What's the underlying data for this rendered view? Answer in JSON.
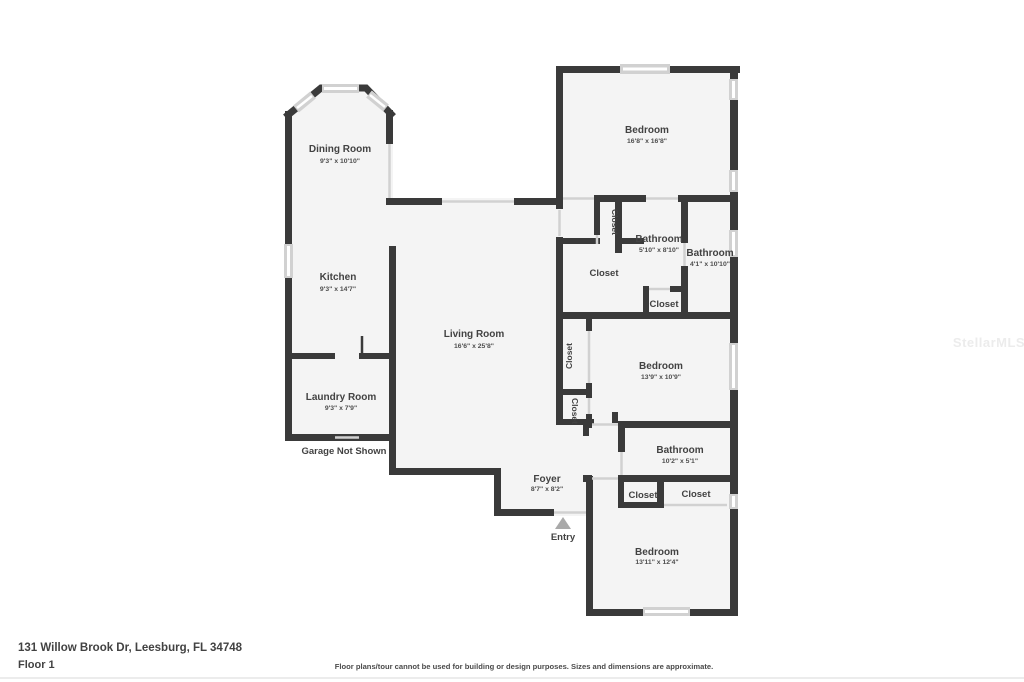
{
  "floorplan": {
    "rooms": {
      "dining": {
        "name": "Dining Room",
        "dims": "9'3\" x 10'10\""
      },
      "kitchen": {
        "name": "Kitchen",
        "dims": "9'3\" x 14'7\""
      },
      "living": {
        "name": "Living Room",
        "dims": "16'6\" x 25'8\""
      },
      "laundry": {
        "name": "Laundry Room",
        "dims": "9'3\" x 7'9\""
      },
      "bedroom_top": {
        "name": "Bedroom",
        "dims": "16'8\" x 16'8\""
      },
      "bath_hall": {
        "name": "Bathroom",
        "dims": "5'10\" x 8'10\""
      },
      "bath_ensuite": {
        "name": "Bathroom",
        "dims": "4'1\" x 10'10\""
      },
      "bedroom_middle": {
        "name": "Bedroom",
        "dims": "13'9\" x 10'9\""
      },
      "bath_lower": {
        "name": "Bathroom",
        "dims": "10'2\" x 5'1\""
      },
      "bedroom_bottom": {
        "name": "Bedroom",
        "dims": "13'11\" x 12'4\""
      },
      "foyer": {
        "name": "Foyer",
        "dims": "8'7\" x 8'2\""
      }
    },
    "closet_label": "Closet",
    "entry_label": "Entry",
    "garage_note": "Garage Not Shown"
  },
  "footer": {
    "address": "131 Willow Brook Dr, Leesburg, FL 34748",
    "floor": "Floor 1",
    "disclaimer": "Floor plans/tour cannot be used for building or design purposes. Sizes and dimensions are approximate."
  },
  "watermark": "StellarMLS",
  "colors": {
    "wall": "#3a3a3a",
    "floor": "#f4f4f4",
    "window": "#d1d1d1",
    "text": "#424242",
    "entry_arrow": "#a9a9a9",
    "watermark": "#ececec"
  }
}
